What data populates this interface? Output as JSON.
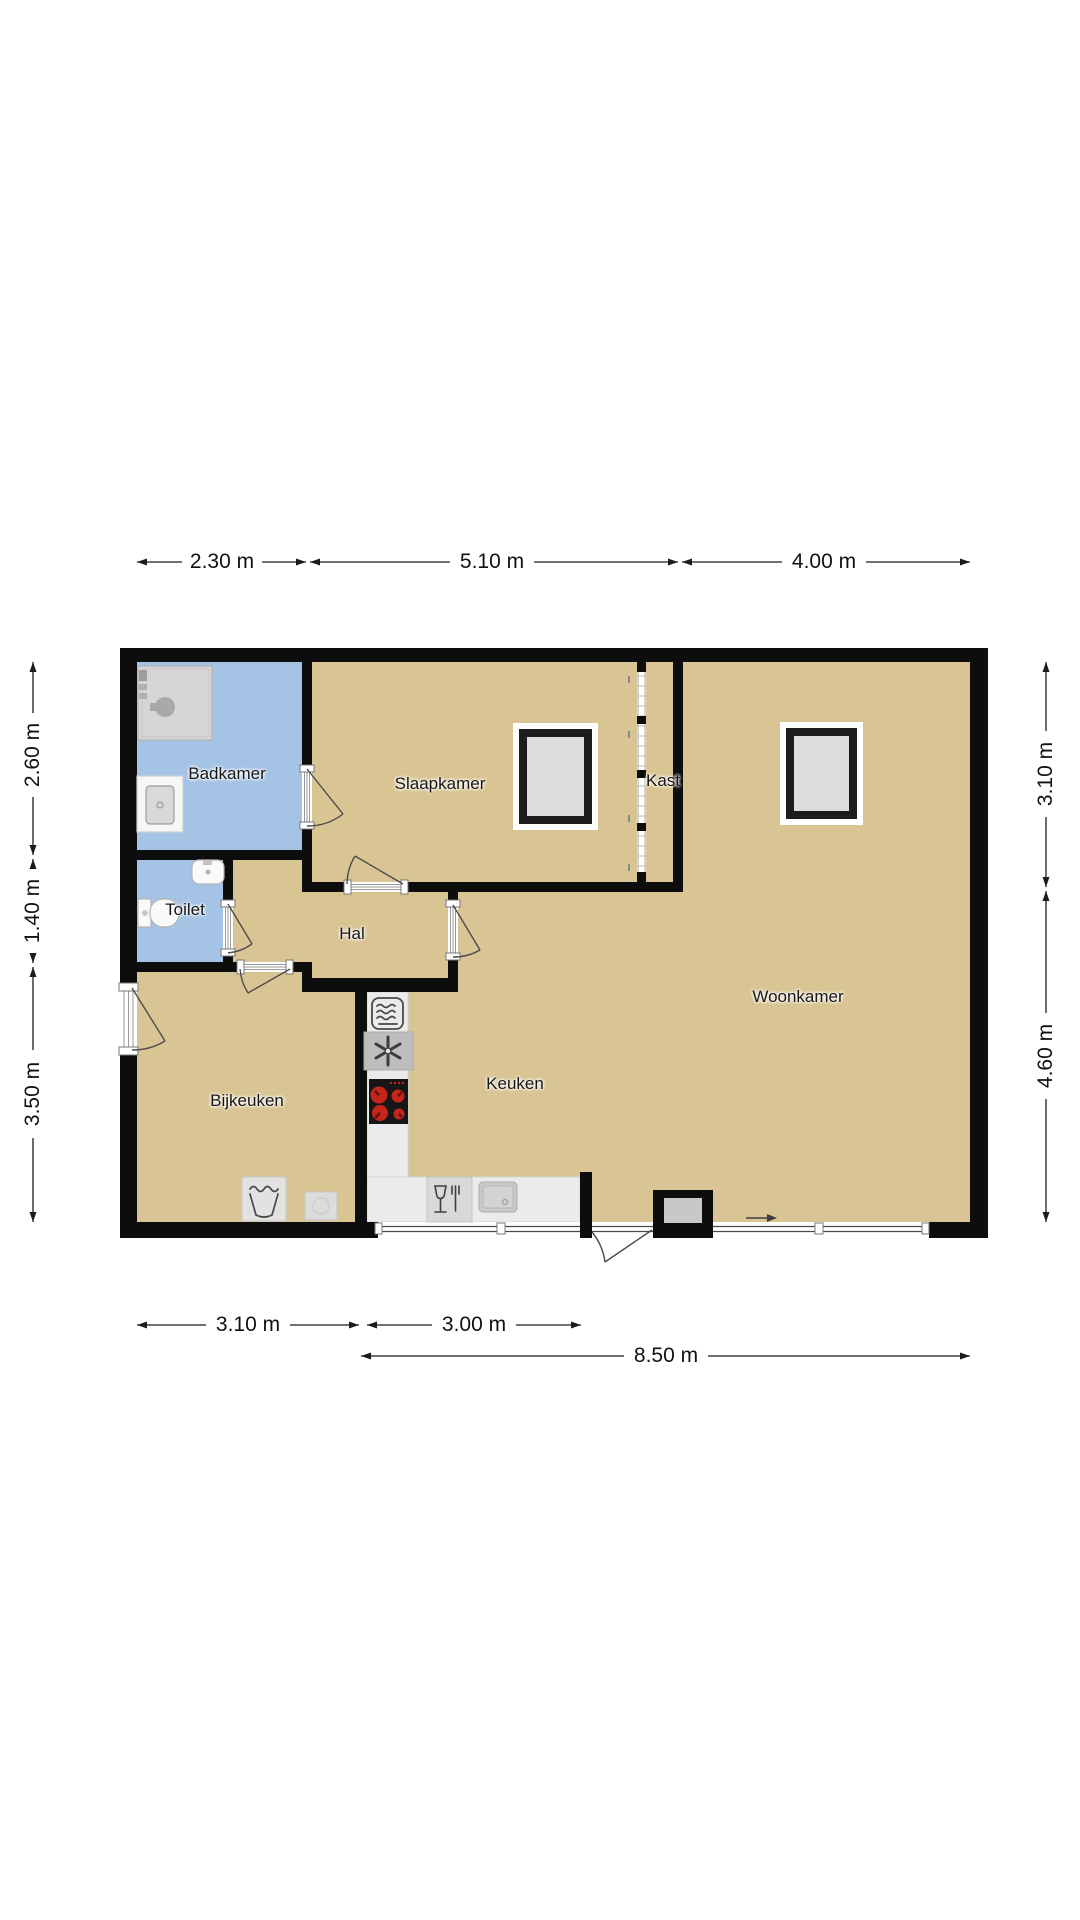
{
  "floorplan": {
    "type": "floor-plan",
    "rooms": {
      "badkamer": {
        "label": "Badkamer"
      },
      "slaapkamer": {
        "label": "Slaapkamer"
      },
      "kast": {
        "label": "Kast"
      },
      "woonkamer": {
        "label": "Woonkamer"
      },
      "toilet": {
        "label": "Toilet"
      },
      "hal": {
        "label": "Hal"
      },
      "bijkeuken": {
        "label": "Bijkeuken"
      },
      "keuken": {
        "label": "Keuken"
      }
    },
    "dimensions": {
      "top": [
        "2.30 m",
        "5.10 m",
        "4.00 m"
      ],
      "left": [
        "2.60 m",
        "1.40 m",
        "3.50 m"
      ],
      "right": [
        "3.10 m",
        "4.60 m"
      ],
      "bottom_inner": [
        "3.10 m",
        "3.00 m"
      ],
      "bottom_outer": [
        "8.50 m"
      ]
    },
    "colors": {
      "floor": "#d9c493",
      "wet_floor": "#a5c3e5",
      "wall": "#0d0d0d",
      "counter": "#ebebeb",
      "appliance_gray": "#bdbdbd",
      "burner_red": "#c5251b",
      "background": "#ffffff"
    },
    "icons": [
      "shower-icon",
      "washbasin-icon",
      "toilet-icon",
      "hand-basin-icon",
      "roof-window-icon",
      "sliding-door-icon",
      "oven-icon",
      "extractor-fan-icon",
      "cooktop-icon",
      "dishwasher-icon",
      "kitchen-sink-icon",
      "washing-machine-icon",
      "boiler-icon",
      "entrance-arrow-icon",
      "door-swing-icon"
    ]
  }
}
